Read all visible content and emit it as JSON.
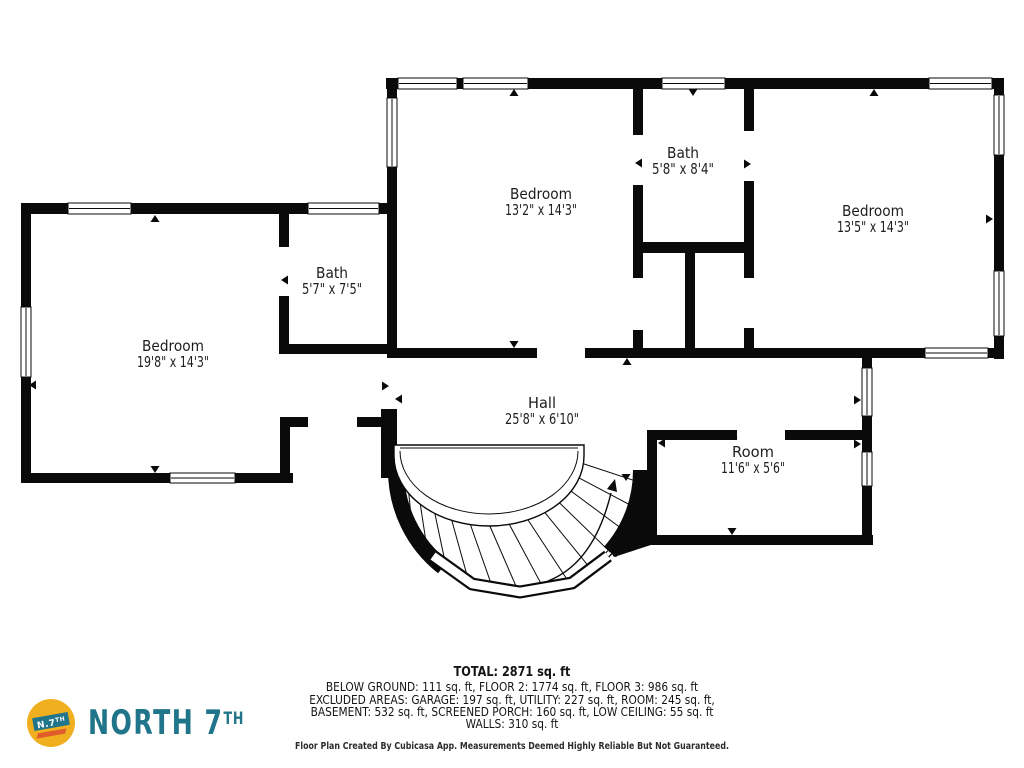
{
  "colors": {
    "wall": "#0a0a0a",
    "label_text": "#1e1e1e",
    "logo_teal": "#20758a",
    "logo_yellow": "#f0af1f",
    "logo_orange": "#e05c2a"
  },
  "rooms": [
    {
      "name": "Bedroom",
      "dims": "13'2\" x 14'3\""
    },
    {
      "name": "Bath",
      "dims": "5'8\" x 8'4\""
    },
    {
      "name": "Bedroom",
      "dims": "13'5\" x 14'3\""
    },
    {
      "name": "Bath",
      "dims": "5'7\" x 7'5\""
    },
    {
      "name": "Bedroom",
      "dims": "19'8\" x 14'3\""
    },
    {
      "name": "Hall",
      "dims": "25'8\" x 6'10\""
    },
    {
      "name": "Room",
      "dims": "11'6\" x 5'6\""
    }
  ],
  "summary": {
    "total": "TOTAL: 2871 sq. ft",
    "line2": "BELOW GROUND: 111 sq. ft, FLOOR 2: 1774 sq. ft, FLOOR 3: 986 sq. ft",
    "line3": "EXCLUDED AREAS: GARAGE: 197 sq. ft, UTILITY: 227 sq. ft, ROOM: 245 sq. ft,",
    "line4": "BASEMENT: 532 sq. ft, SCREENED PORCH: 160 sq. ft, LOW CEILING: 55 sq. ft",
    "line5": "WALLS: 310 sq. ft",
    "disclaimer": "Floor Plan Created By Cubicasa App. Measurements Deemed Highly Reliable But Not Guaranteed."
  },
  "logo": {
    "brand_main": "NORTH 7",
    "brand_sup": "TH",
    "badge_text": "N.7",
    "badge_sup": "TH"
  }
}
